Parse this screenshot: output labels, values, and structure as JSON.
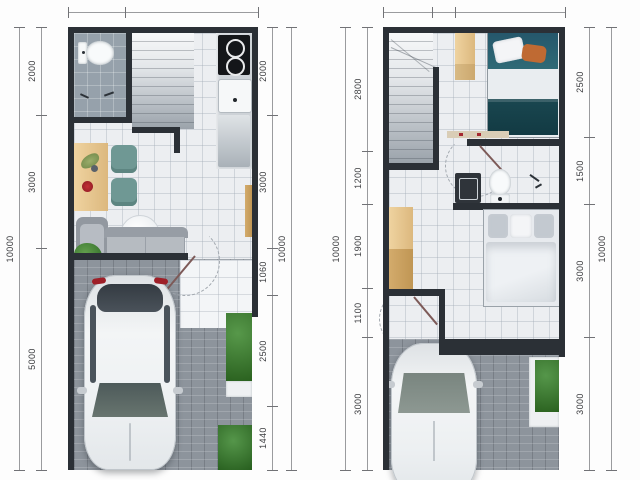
{
  "document": {
    "kind": "architectural floor plan drawing, two storeys side by side",
    "units": "mm"
  },
  "colors": {
    "wall": "#2b3036",
    "floor_tile": "#eceef1",
    "bath_tile": "#96a1ab",
    "paver": "#8d949c",
    "wood": "#e6c28e",
    "chair_teal": "#6f9894",
    "sofa_gray": "#b4b9c0",
    "plant_green": "#3f7d35",
    "bed_teal_pillow": "#2b5f6c",
    "bed_teal_blanket": "#1a4750",
    "taillight_red": "#9e1f28",
    "dim_line": "#9a9b9e",
    "dim_text": "#3b3c3f"
  },
  "chart_data": {
    "type": "table",
    "title": "",
    "plans": [
      {
        "id": "ground-floor",
        "top_dims": [
          {
            "label": "1200",
            "value": 1200
          },
          {
            "label": "2800",
            "value": 2800
          }
        ],
        "left_outer_dims": [
          {
            "label": "10000",
            "value": 10000
          }
        ],
        "left_inner_dims": [
          {
            "label": "2000",
            "value": 2000
          },
          {
            "label": "3000",
            "value": 3000
          },
          {
            "label": "5000",
            "value": 5000
          }
        ],
        "right_inner_dims": [
          {
            "label": "2000",
            "value": 2000
          },
          {
            "label": "3000",
            "value": 3000
          },
          {
            "label": "1060",
            "value": 1060
          },
          {
            "label": "2500",
            "value": 2500
          },
          {
            "label": "1440",
            "value": 1440
          }
        ],
        "right_outer_dims": [
          {
            "label": "10000",
            "value": 10000
          }
        ]
      },
      {
        "id": "upper-floor",
        "top_dims": [
          {
            "label": "1090",
            "value": 1090
          },
          {
            "label": "510",
            "value": 510
          },
          {
            "label": "2400",
            "value": 2400
          }
        ],
        "left_outer_dims": [
          {
            "label": "10000",
            "value": 10000
          }
        ],
        "left_inner_dims": [
          {
            "label": "2800",
            "value": 2800
          },
          {
            "label": "1200",
            "value": 1200
          },
          {
            "label": "1900",
            "value": 1900
          },
          {
            "label": "1100",
            "value": 1100
          },
          {
            "label": "3000",
            "value": 3000
          }
        ],
        "right_inner_dims": [
          {
            "label": "2500",
            "value": 2500
          },
          {
            "label": "1500",
            "value": 1500
          },
          {
            "label": "3000",
            "value": 3000
          },
          {
            "label": "3000",
            "value": 3000
          }
        ],
        "right_outer_dims": [
          {
            "label": "10000",
            "value": 10000
          }
        ]
      }
    ]
  }
}
